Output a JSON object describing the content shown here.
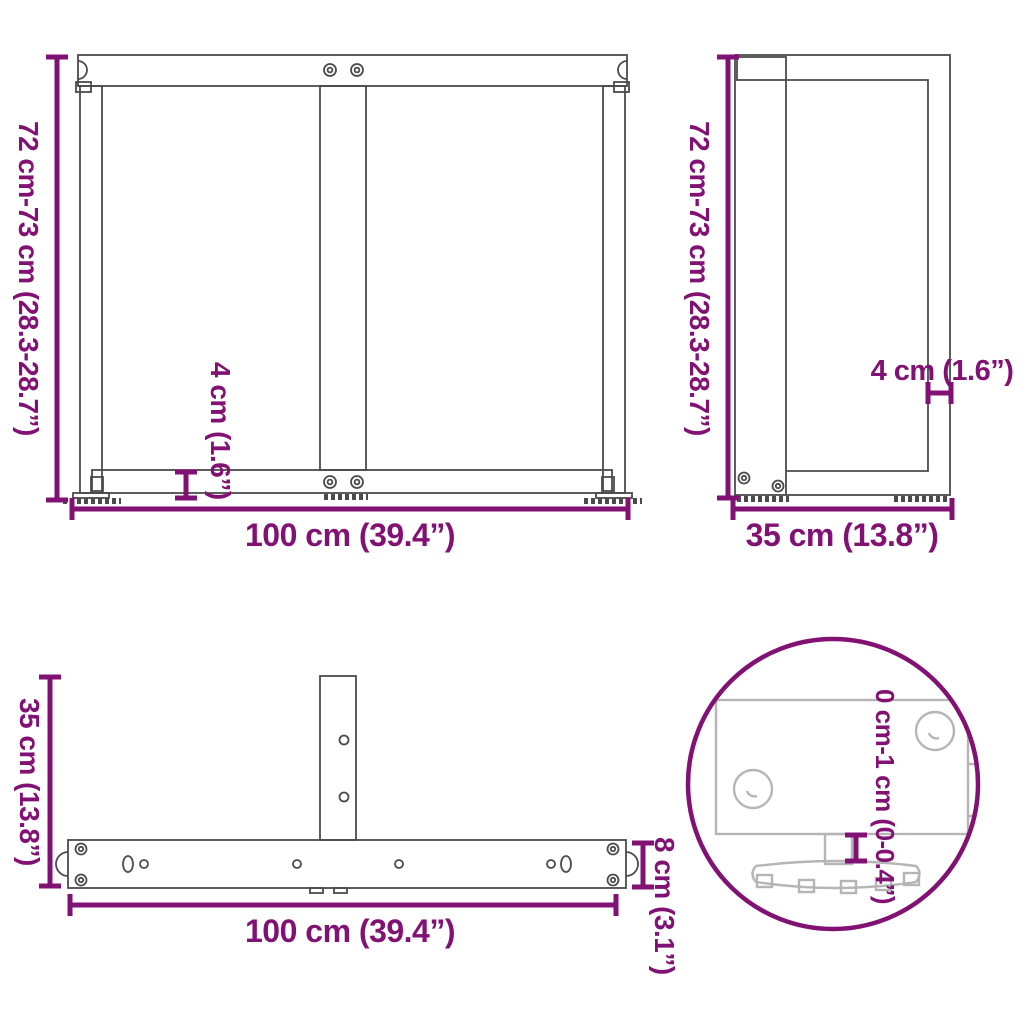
{
  "colors": {
    "accent": "#821174",
    "drawing": "#4b4b4b",
    "drawing_light": "#b5b5b5",
    "background": "#ffffff"
  },
  "views": {
    "front": {
      "height": "72 cm-73 cm (28.3-28.7”)",
      "bottom_bar_thickness": "4 cm (1.6”)",
      "width": "100 cm (39.4”)"
    },
    "side": {
      "height": "72 cm-73 cm (28.3-28.7”)",
      "bar_thickness": "4 cm (1.6”)",
      "depth": "35 cm (13.8”)"
    },
    "top": {
      "depth": "35 cm (13.8”)",
      "width": "100 cm (39.4”)",
      "bar_height": "8 cm (3.1”)"
    },
    "detail": {
      "adjustable_range": "0 cm-1 cm (0-0.4”)"
    }
  }
}
